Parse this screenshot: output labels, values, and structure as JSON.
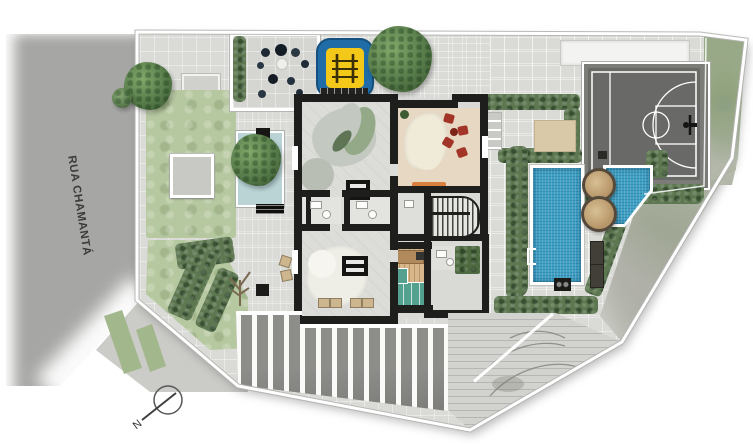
{
  "plan": {
    "street_label": "RUA CHAMANTÁ",
    "north_label": "N"
  },
  "icons": {
    "climbing_frame_icon": "playground climbing-frame glyph (two posts, three bars)",
    "basketball_hoop_icon": "backboard and rim mark on court edge",
    "pool_ladder_icon": "white ladder bracket on pool edge",
    "north_arrow_icon": "circle with diagonal needle and N letter"
  },
  "colors": {
    "street": "#a6a6a4",
    "sidewalk": "#cbcbc8",
    "paving": "#dadad7",
    "lawn": "#b6c8a0",
    "hedge": "#5d7751",
    "water": "#bad4d6",
    "playground_blue": "#1f6ca6",
    "playground_yellow": "#f3c818",
    "court": "#696967",
    "court_apron": "#7b7b78",
    "pool": "#3fa0c4",
    "wall": "#1e1e1c",
    "floor": "#dcdcd9",
    "beige": "#e7d8c3",
    "rug_cream": "#f0ead9",
    "rug_green": "#93a987",
    "chair_red": "#a23527",
    "bench_orange": "#d8813e",
    "wood": "#d7b78b",
    "teal": "#55a18f",
    "deck": "#8d8d8a",
    "lounger": "#413f38",
    "sand": "#d9c9a8"
  }
}
